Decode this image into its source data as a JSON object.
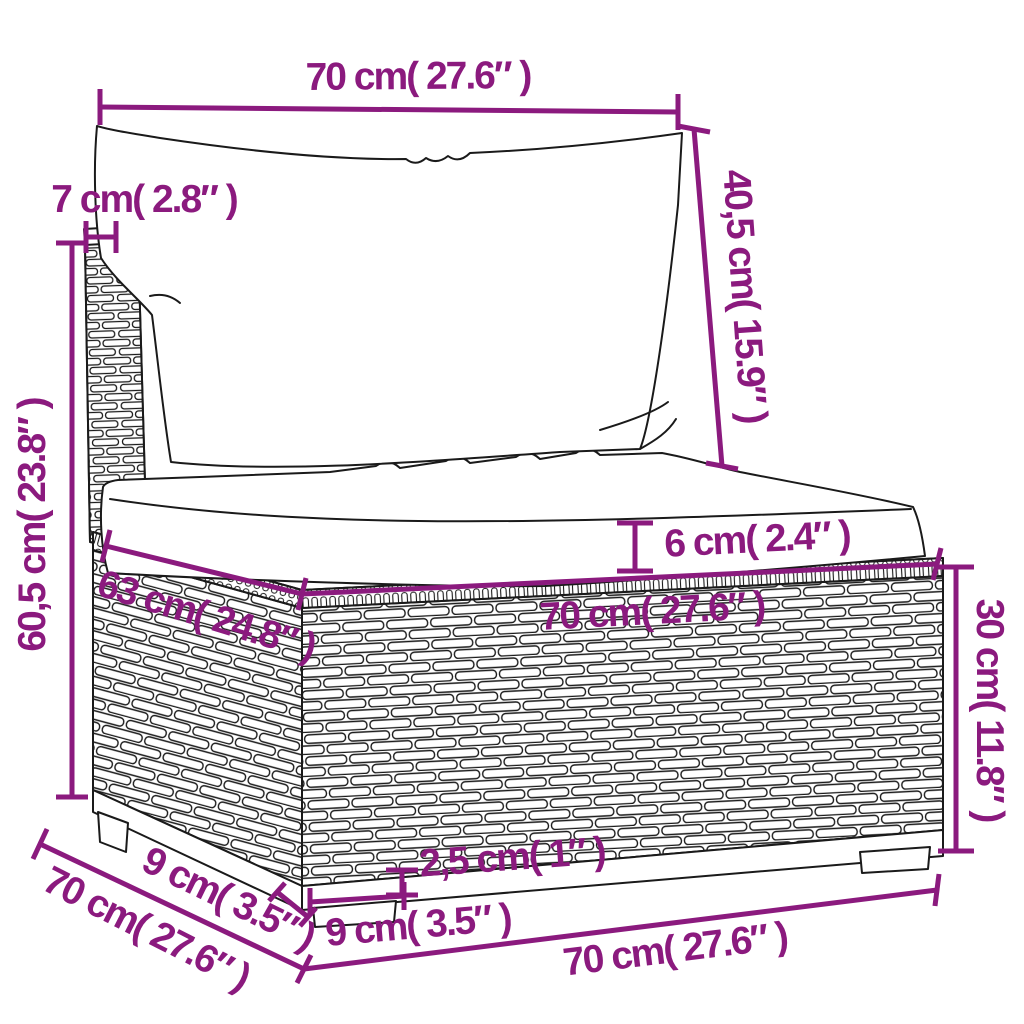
{
  "diagram_type": "furniture-dimension-drawing",
  "subject": "rattan-sofa-middle-section-with-cushions",
  "colors": {
    "dimension_accent": "#8B1A7E",
    "line_art": "#1A1A1A",
    "background": "#FFFFFF"
  },
  "dimensions": [
    {
      "id": "top-width",
      "cm": "70",
      "inches": "27.6",
      "text": "70 cm( 27.6″ )"
    },
    {
      "id": "back-cushion-height",
      "cm": "40,5",
      "inches": "15.9",
      "text": "40,5 cm( 15.9″ )"
    },
    {
      "id": "back-post-depth",
      "cm": "7",
      "inches": "2.8",
      "text": "7 cm( 2.8″ )"
    },
    {
      "id": "back-total-height",
      "cm": "60,5",
      "inches": "23.8",
      "text": "60,5 cm( 23.8″ )"
    },
    {
      "id": "seat-cushion-thickness",
      "cm": "6",
      "inches": "2.4",
      "text": "6 cm( 2.4″ )"
    },
    {
      "id": "seat-side-depth",
      "cm": "63",
      "inches": "24.8",
      "text": "63 cm( 24.8″ )"
    },
    {
      "id": "seat-front-width",
      "cm": "70",
      "inches": "27.6",
      "text": "70 cm( 27.6″ )"
    },
    {
      "id": "base-height",
      "cm": "30",
      "inches": "11.8",
      "text": "30 cm( 11.8″ )"
    },
    {
      "id": "foot-plinth-height",
      "cm": "2,5",
      "inches": "1",
      "text": "2,5 cm( 1″ )"
    },
    {
      "id": "leg-front-width",
      "cm": "9",
      "inches": "3.5",
      "text": "9 cm( 3.5″ )"
    },
    {
      "id": "leg-side-depth",
      "cm": "9",
      "inches": "3.5",
      "text": "9 cm( 3.5″ )"
    },
    {
      "id": "total-depth",
      "cm": "70",
      "inches": "27.6",
      "text": "70 cm( 27.6″ )"
    },
    {
      "id": "bottom-front-width",
      "cm": "70",
      "inches": "27.6",
      "text": "70 cm( 27.6″ )"
    }
  ]
}
